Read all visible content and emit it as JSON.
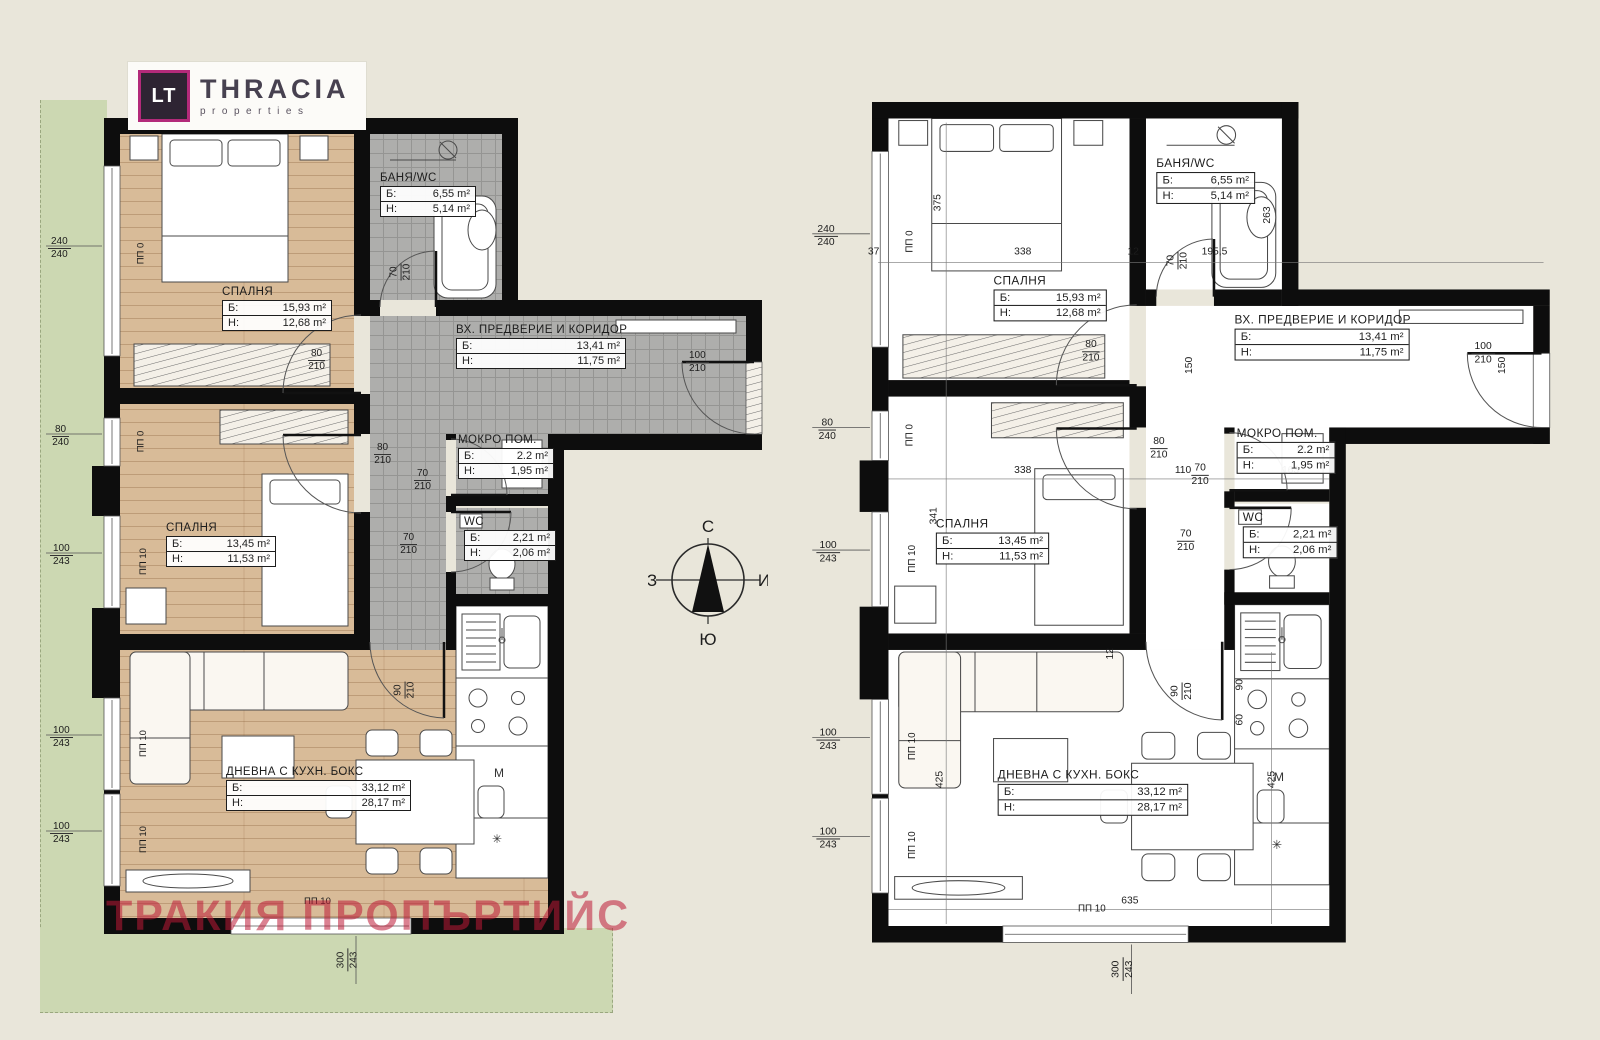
{
  "logo": {
    "monogram": "LT",
    "brand": "THRACIA",
    "subtitle": "properties"
  },
  "watermark": "ТРАКИЯ ПРОПЪРТИЙС",
  "compass": {
    "north": "С",
    "south": "Ю",
    "west": "З",
    "east": "И"
  },
  "rooms": {
    "bathroom": {
      "name": "БАНЯ/WC",
      "rows": [
        [
          "Б:",
          "6,55 m²"
        ],
        [
          "H:",
          "5,14 m²"
        ]
      ]
    },
    "bedroom1": {
      "name": "СПАЛНЯ",
      "rows": [
        [
          "Б:",
          "15,93 m²"
        ],
        [
          "H:",
          "12,68 m²"
        ]
      ]
    },
    "corridor": {
      "name": "ВХ. ПРЕДВЕРИЕ И КОРИДОР",
      "rows": [
        [
          "Б:",
          "13,41 m²"
        ],
        [
          "H:",
          "11,75 m²"
        ]
      ]
    },
    "utility": {
      "name": "МОКРО ПОМ.",
      "rows": [
        [
          "Б:",
          "2.2 m²"
        ],
        [
          "H:",
          "1,95 m²"
        ]
      ]
    },
    "wc": {
      "name": "WC",
      "rows": [
        [
          "Б:",
          "2,21 m²"
        ],
        [
          "H:",
          "2,06 m²"
        ]
      ]
    },
    "bedroom2": {
      "name": "СПАЛНЯ",
      "rows": [
        [
          "Б:",
          "13,45 m²"
        ],
        [
          "H:",
          "11,53 m²"
        ]
      ]
    },
    "living": {
      "name": "ДНЕВНА С КУХН. БОКС",
      "rows": [
        [
          "Б:",
          "33,12 m²"
        ],
        [
          "H:",
          "28,17 m²"
        ]
      ]
    }
  },
  "dims_both": [
    {
      "a": "240",
      "b": "240",
      "x": -56,
      "y": 118,
      "v": false
    },
    {
      "a": "80",
      "b": "240",
      "x": -52,
      "y": 306,
      "v": false
    },
    {
      "a": "100",
      "b": "243",
      "x": -54,
      "y": 425,
      "v": false
    },
    {
      "a": "100",
      "b": "243",
      "x": -54,
      "y": 607,
      "v": false
    },
    {
      "a": "100",
      "b": "243",
      "x": -54,
      "y": 703,
      "v": false
    },
    {
      "a": "300",
      "b": "243",
      "x": 232,
      "y": 830,
      "v": true
    },
    {
      "a": "70",
      "b": "210",
      "x": 288,
      "y": 142,
      "v": true
    },
    {
      "a": "80",
      "b": "210",
      "x": 204,
      "y": 230,
      "v": false
    },
    {
      "a": "80",
      "b": "210",
      "x": 270,
      "y": 324,
      "v": false
    },
    {
      "a": "70",
      "b": "210",
      "x": 310,
      "y": 350,
      "v": false
    },
    {
      "a": "70",
      "b": "210",
      "x": 296,
      "y": 414,
      "v": false
    },
    {
      "a": "90",
      "b": "210",
      "x": 292,
      "y": 560,
      "v": true
    },
    {
      "a": "100",
      "b": "210",
      "x": 582,
      "y": 232,
      "v": false
    }
  ],
  "pp_labels": [
    {
      "t": "ПП 0",
      "x": 26,
      "y": 130,
      "v": true
    },
    {
      "t": "ПП 0",
      "x": 26,
      "y": 318,
      "v": true
    },
    {
      "t": "ПП 10",
      "x": 26,
      "y": 438,
      "v": true
    },
    {
      "t": "ПП 10",
      "x": 26,
      "y": 620,
      "v": true
    },
    {
      "t": "ПП 10",
      "x": 26,
      "y": 716,
      "v": true
    },
    {
      "t": "ПП 10",
      "x": 200,
      "y": 778,
      "v": false
    }
  ],
  "marks": [
    {
      "t": "П",
      "x": 412,
      "y": 330
    },
    {
      "t": "М",
      "x": 390,
      "y": 648
    },
    {
      "t": "✳",
      "x": 388,
      "y": 714
    }
  ],
  "dims_right": [
    {
      "a": "37",
      "x": -4,
      "y": 140
    },
    {
      "a": "375",
      "x": 56,
      "y": 92,
      "v": true
    },
    {
      "a": "338",
      "x": 138,
      "y": 140
    },
    {
      "a": "12",
      "x": 248,
      "y": 140
    },
    {
      "a": "195,5",
      "x": 320,
      "y": 140
    },
    {
      "a": "263",
      "x": 376,
      "y": 104,
      "v": true
    },
    {
      "a": "150",
      "x": 300,
      "y": 250,
      "v": true
    },
    {
      "a": "150",
      "x": 604,
      "y": 250,
      "v": true
    },
    {
      "a": "341",
      "x": 52,
      "y": 396,
      "v": true
    },
    {
      "a": "338",
      "x": 138,
      "y": 352
    },
    {
      "a": "110",
      "x": 294,
      "y": 352
    },
    {
      "a": "163",
      "x": 398,
      "y": 352
    },
    {
      "a": "12",
      "x": 226,
      "y": 530,
      "v": true
    },
    {
      "a": "425",
      "x": 58,
      "y": 652,
      "v": true
    },
    {
      "a": "425",
      "x": 380,
      "y": 652,
      "v": true
    },
    {
      "a": "635",
      "x": 242,
      "y": 770
    },
    {
      "a": "90",
      "x": 352,
      "y": 560,
      "v": true
    },
    {
      "a": "60",
      "x": 352,
      "y": 594,
      "v": true
    }
  ]
}
